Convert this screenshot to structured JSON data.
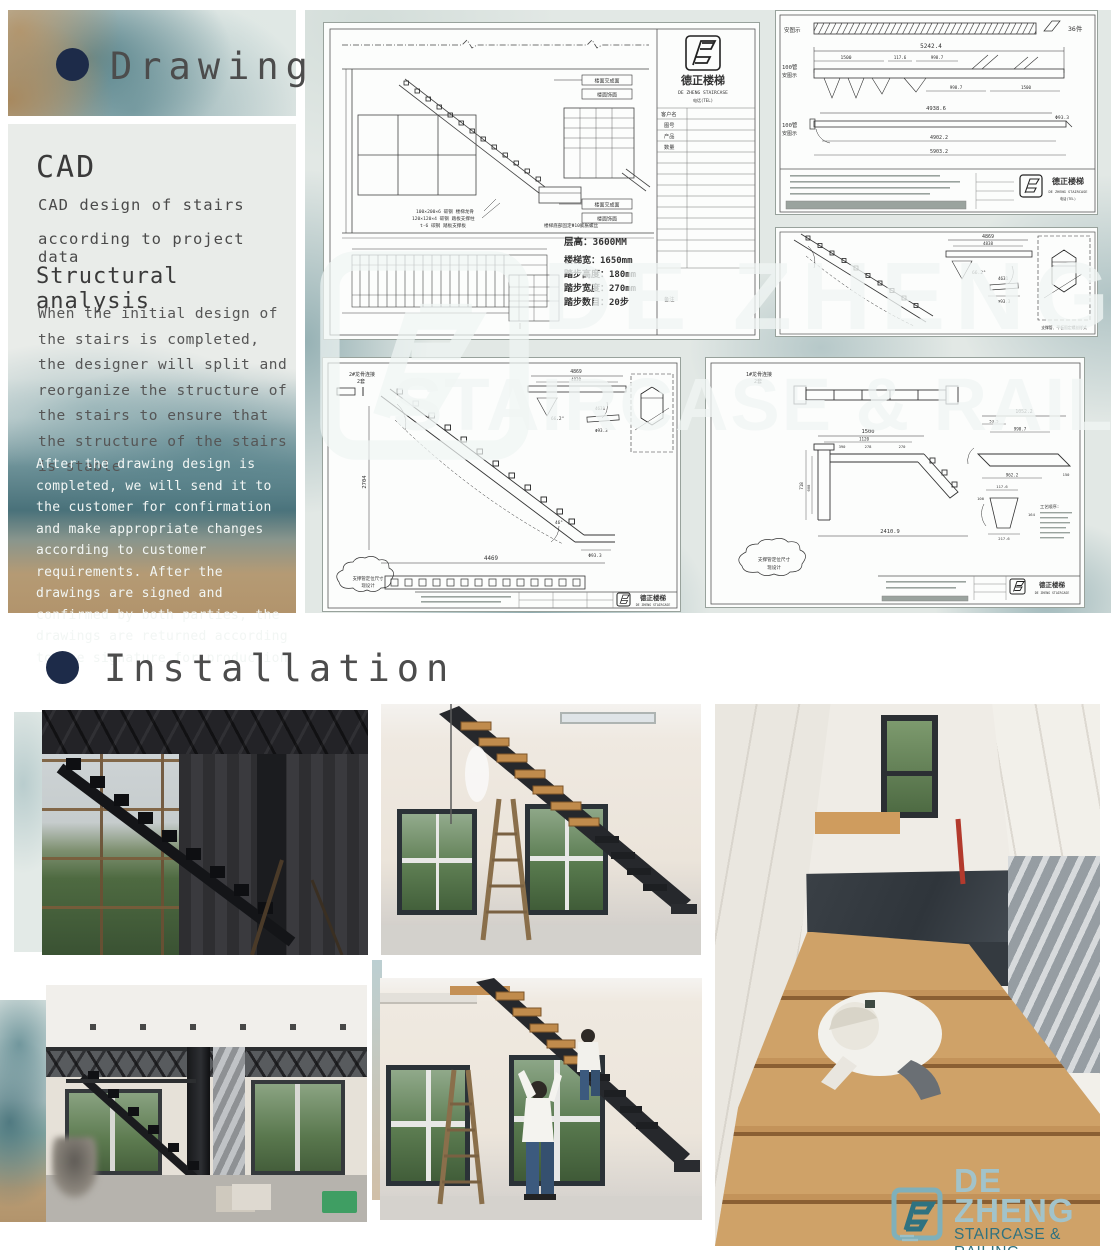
{
  "colors": {
    "accent_navy": "#1d2b49",
    "teal_dark": "#2f7280",
    "teal_light": "#a2c3ca",
    "watercolor_teal": "#4d7c86",
    "watercolor_tan": "#b5976e",
    "paper": "#e9ece9"
  },
  "drawing": {
    "title": "Drawing",
    "cad_heading": "CAD",
    "cad_line1": "CAD design of stairs",
    "cad_line2": "according to project data",
    "structural_heading": "Structural analysis",
    "para1": "When the initial design of the stairs is completed, the designer will split and reorganize the structure of the stairs to ensure that the structure of the stairs is stable",
    "para2": "After the drawing design is completed, we will send it to the customer for confirmation and make appropriate changes according to customer requirements. After the drawings are signed and confirmed by both parties, the drawings are returned according to the signature for production"
  },
  "watermark": {
    "line1": "DE ZHENG",
    "line2": "STAIRCASE & RAILING"
  },
  "company": {
    "name_cn": "德正楼梯",
    "name_en": "DE ZHENG STAIRCASE",
    "phone_label": "电话(TEL)"
  },
  "sheet_a": {
    "specs": [
      "层高：3600MM",
      "楼梯宽：1650mm",
      "踏步高度：180mm",
      "踏步宽度：270mm",
      "踏步数目：20步"
    ],
    "floor_label1": "楼面交成面",
    "floor_label2": "楼面饰面",
    "notes": [
      "100×200×6 碳钢 楼梯龙骨",
      "120×120×4 碳钢 踏板支撑柱",
      "t-6 碳钢 踏板支撑板"
    ],
    "note_right": "楼梯底部固定Φ10膨胀螺丝",
    "tb_rows": [
      "客户名",
      "图号",
      "产品",
      "数量",
      "备注"
    ]
  },
  "sheet_b": {
    "row_label": "安图示",
    "pipe_label": "100管",
    "count": "36件",
    "dims": [
      "5242.4",
      "1500",
      "117.6",
      "998.7",
      "4938.6",
      "4902.2",
      "5903.2",
      "Φ93.3"
    ]
  },
  "sheet_c": {
    "dims": [
      "4869",
      "4838",
      "66.2°",
      "4631",
      "Φ93.3"
    ],
    "detail_note": "支撑管、平板固定螺丝样式"
  },
  "sheet_d": {
    "label1": "2#龙骨连接",
    "label2": "2套",
    "dims": [
      "2704",
      "4469",
      "4869",
      "4830",
      "66.2°",
      "4631",
      "Φ93.3",
      "46°"
    ],
    "cloud1": "支撑管定位尺寸",
    "cloud2": "现设计"
  },
  "sheet_e": {
    "label1": "1#龙骨连接",
    "label2": "2套",
    "dims": [
      "1500",
      "1120",
      "390",
      "278",
      "270",
      "718",
      "608",
      "2410.9",
      "1052.2",
      "53.5",
      "998.7",
      "962.2",
      "150",
      "117.6",
      "100",
      "164",
      "217.6"
    ],
    "cloud1": "支撑管定位尺寸",
    "cloud2": "现设计",
    "process_label": "工艺顺序:"
  },
  "installation": {
    "title": "Installation",
    "photos": [
      {
        "subject": "steel stringer installed against factory window wall"
      },
      {
        "subject": "mono stringer staircase with wood treads being installed"
      },
      {
        "subject": "top view of finished wooden staircase with installer"
      },
      {
        "subject": "steel stair structure inside building under construction"
      },
      {
        "subject": "workers fitting wood treads on steel staircase"
      }
    ]
  },
  "footer_logo": {
    "brand": "DE ZHENG",
    "tagline": "STAIRCASE & RAILING"
  }
}
